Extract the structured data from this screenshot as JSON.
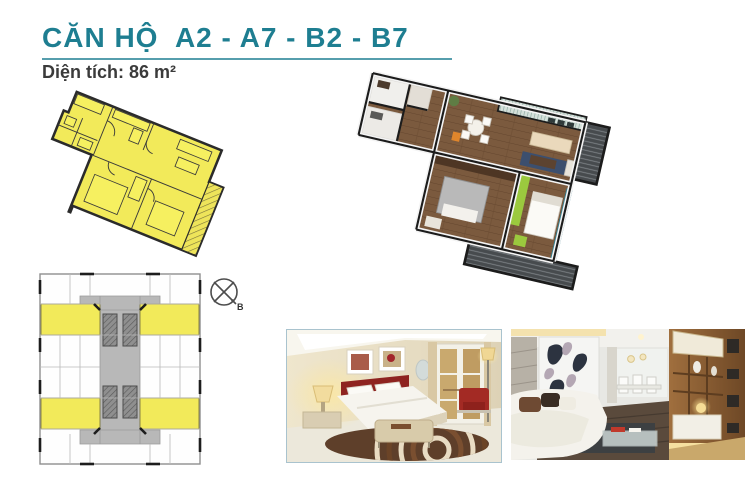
{
  "page": {
    "title": "CĂN HỘ  A2 - A7 - B2 - B7",
    "subtitle": "Diện tích: 86 m²"
  },
  "colors": {
    "accent_teal": "#1e7e91",
    "unit_highlight_yellow": "#f2ea5a",
    "plan_wood": "#7b5a3e",
    "balcony_gray": "#474b4e",
    "wardrobe_green": "#9bc93e"
  },
  "floor_plan_2d": {
    "name": "2d-unit-floor-plan",
    "fill": "#f2ea5a"
  },
  "floor_plan_3d": {
    "name": "3d-unit-render"
  },
  "site_plan": {
    "name": "typical-floor-plate",
    "compass_label": "B"
  },
  "photos": [
    {
      "name": "bedroom-photo"
    },
    {
      "name": "living-room-photo"
    }
  ]
}
